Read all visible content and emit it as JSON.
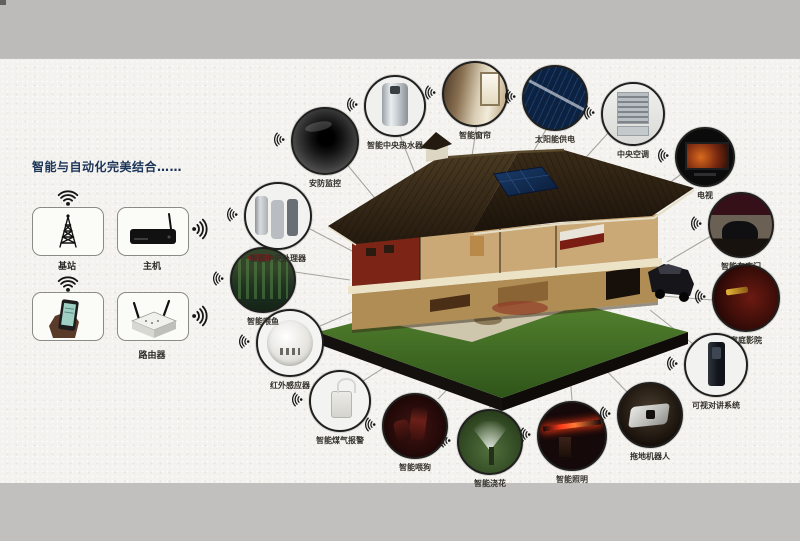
{
  "canvas": {
    "width": 800,
    "height": 541
  },
  "colors": {
    "band_gray": "#c1c0be",
    "paper": "#f3f2ee",
    "title_navy": "#1c3457",
    "connector_gray": "#a7a59e",
    "label_dark": "#33302a",
    "roof_brown": "#3a2c18",
    "grass_green": "#4e7a2c",
    "solar_blue": "#1a3d6b"
  },
  "left_panel": {
    "title": "智能与自动化完美结合……",
    "hubs": [
      {
        "label": "基站",
        "icon": "signal-tower-icon"
      },
      {
        "label": "主机",
        "icon": "host-box-icon"
      },
      {
        "label": "",
        "icon": "smartphone-hand-icon"
      },
      {
        "label": "路由器",
        "icon": "wireless-router-icon"
      }
    ]
  },
  "house": {
    "illustration": "smart-home-cutaway-villa"
  },
  "devices": [
    {
      "label": "安防监控",
      "photo": "security-camera"
    },
    {
      "label": "智能中央热水器",
      "photo": "central-water-heater"
    },
    {
      "label": "智能窗帘",
      "photo": "smart-curtain"
    },
    {
      "label": "太阳能供电",
      "photo": "solar-power"
    },
    {
      "label": "中央空调",
      "photo": "central-air-conditioner"
    },
    {
      "label": "电视",
      "photo": "television"
    },
    {
      "label": "智能车库门",
      "photo": "garage-door"
    },
    {
      "label": "家庭影院",
      "photo": "home-theater"
    },
    {
      "label": "可视对讲系统",
      "photo": "video-intercom"
    },
    {
      "label": "拖地机器人",
      "photo": "mopping-robot"
    },
    {
      "label": "智能照明",
      "photo": "smart-lighting"
    },
    {
      "label": "智能浇花",
      "photo": "smart-watering"
    },
    {
      "label": "智能喂狗",
      "photo": "pet-feeder"
    },
    {
      "label": "智能煤气报警",
      "photo": "gas-alarm"
    },
    {
      "label": "红外感应器",
      "photo": "infrared-sensor"
    },
    {
      "label": "智能喂鱼",
      "photo": "fish-feeder"
    },
    {
      "label": "智能中央处理器",
      "photo": "central-processor"
    }
  ]
}
